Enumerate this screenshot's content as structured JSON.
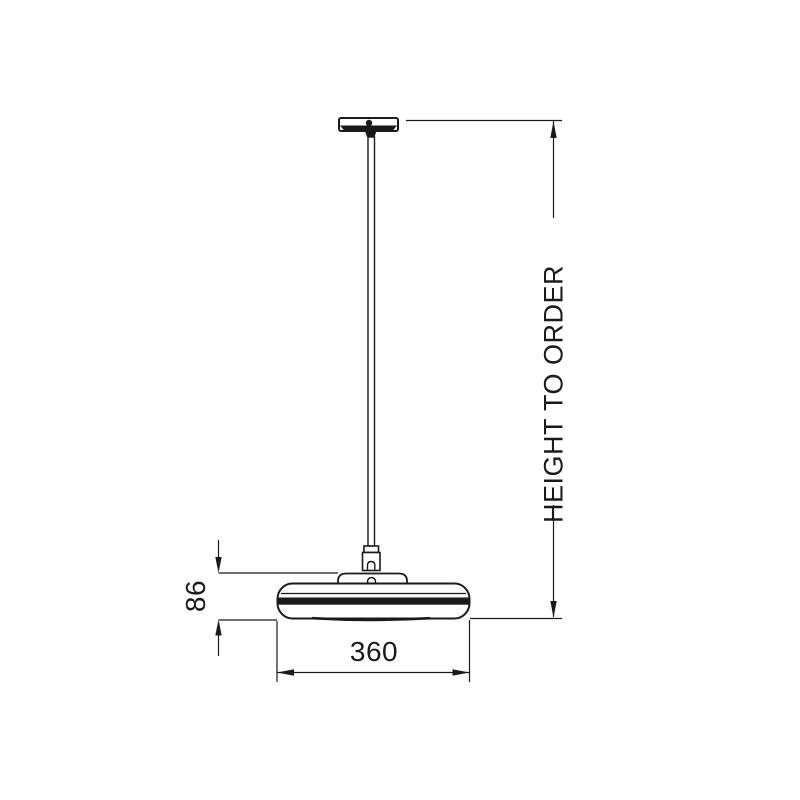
{
  "canvas": {
    "background": "#ffffff",
    "line_color": "#1a1a1a"
  },
  "drawing": {
    "kind_labels": {
      "height_dimension": "HEIGHT TO ORDER",
      "shade_height_mm": "86",
      "shade_width_mm": "360"
    }
  },
  "dimensions": {
    "height": {
      "label": "HEIGHT TO ORDER",
      "orientation": "vertical"
    },
    "shade_height": {
      "label": "86",
      "orientation": "vertical"
    },
    "shade_width": {
      "label": "360",
      "orientation": "horizontal"
    }
  }
}
